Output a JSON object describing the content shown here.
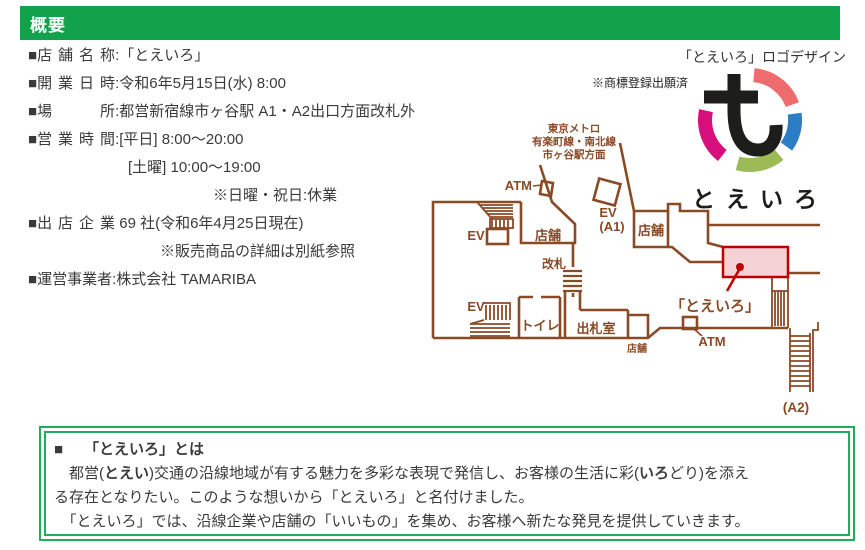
{
  "header": {
    "title": "概要"
  },
  "info": {
    "bullet": "■",
    "l1": {
      "label": "店舗名称",
      "value": ":「とえいろ」"
    },
    "l2": {
      "label": "開業日時",
      "value": ":令和6年5月15日(水) 8:00"
    },
    "l3": {
      "label": "場所",
      "value": ":都営新宿線市ヶ谷駅 A1・A2出口方面改札外"
    },
    "l4": {
      "label": "営業時間",
      "value": ":[平日] 8:00〜20:00"
    },
    "l5": {
      "value": "[土曜] 10:00〜19:00"
    },
    "l6": {
      "value": "※日曜・祝日:休業"
    },
    "l7": {
      "label": "出店企業",
      "value": " 69 社(令和6年4月25日現在)"
    },
    "l8": {
      "value": "※販売商品の詳細は別紙参照"
    },
    "l9": {
      "label": "運営事業者",
      "value": ":株式会社 TAMARIBA"
    }
  },
  "logo": {
    "caption": "「とえいろ」ロゴデザイン",
    "trademark_note": "※商標登録出願済",
    "wordmark": "とえいろ",
    "colors": {
      "coral": "#ee6c6d",
      "blue": "#2b7ec4",
      "green": "#9cba55",
      "magenta": "#d60f7d",
      "glyph": "#1d1d1b"
    }
  },
  "map": {
    "line_color": "#8a4a26",
    "store_red": "#c00000",
    "store_fill": "#f5d2d6",
    "metro1": "東京メトロ",
    "metro2": "有楽町線・南北線",
    "metro3": "市ヶ谷駅方面",
    "atm_upper": "ATM",
    "ev_a1_label": "EV",
    "a1": "(A1)",
    "shop_upper_left": "店舗",
    "shop_right": "店舗",
    "shop_lower": "店舗",
    "kaisatsu": "改札",
    "ev_upper": "EV",
    "ev_lower": "EV",
    "toilet": "トイレ",
    "ticket_office": "出札室",
    "atm_lower": "ATM",
    "store_label": "「とえいろ」",
    "a2": "(A2)"
  },
  "about": {
    "bullet": "■",
    "title": "「とえいろ」とは",
    "p1a": "　都営(",
    "p1b": "とえい",
    "p1c": ")交通の沿線地域が有する魅力を多彩な表現で発信し、お客様の生活に彩(",
    "p1d": "いろ",
    "p1e": "どり)を添え",
    "p2": "る存在となりたい。このような想いから「とえいろ」と名付けました。",
    "p3": "　「とえいろ」では、沿線企業や店舗の「いいもの」を集め、お客様へ新たな発見を提供していきます。"
  }
}
